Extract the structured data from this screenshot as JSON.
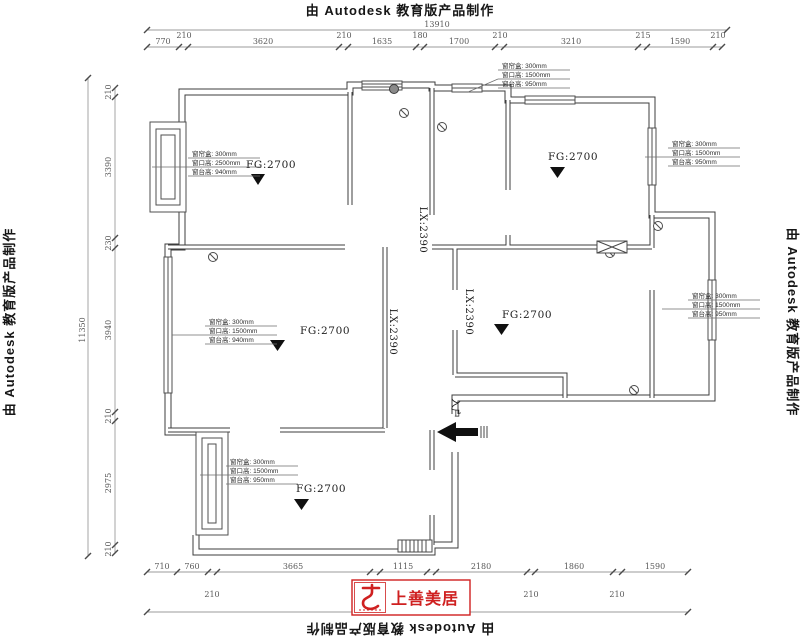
{
  "watermarks": {
    "top": "由 Autodesk 教育版产品制作",
    "bottom": "由 Autodesk 教育版产品制作",
    "left": "由 Autodesk 教育版产品制作",
    "right": "由 Autodesk 教育版产品制作"
  },
  "logo": {
    "text": "上善美居"
  },
  "rooms": {
    "fg_label": "FG:2700",
    "lx_label": "LX:2390",
    "entry_label": "入户"
  },
  "callout_rows": {
    "left_top": [
      "窗帘盒: 300mm",
      "窗口高: 2500mm",
      "窗台高: 940mm"
    ],
    "top_right": [
      "窗帘盒: 300mm",
      "窗口高: 1500mm",
      "窗台高: 950mm"
    ],
    "right_top": [
      "窗帘盒: 300mm",
      "窗口高: 1500mm",
      "窗台高: 950mm"
    ],
    "right_middle": [
      "窗帘盒: 300mm",
      "窗口高: 1500mm",
      "窗台高: 950mm"
    ],
    "left_middle": [
      "窗帘盒: 300mm",
      "窗口高: 1500mm",
      "窗台高: 940mm"
    ],
    "bottom": [
      "窗帘盒: 300mm",
      "窗口高: 1500mm",
      "窗台高: 950mm"
    ]
  },
  "dims": {
    "top": {
      "overall": "13910",
      "segments": [
        "770",
        "210",
        "3620",
        "210",
        "1635",
        "180",
        "1700",
        "210",
        "3210",
        "215",
        "1590",
        "210"
      ]
    },
    "left": {
      "overall": "11350",
      "segments": [
        "210",
        "3390",
        "230",
        "3940",
        "210",
        "2975",
        "210"
      ]
    },
    "bottom": {
      "overall": "13910",
      "row1": [
        "710",
        "760",
        "3665",
        "1115",
        "2180",
        "1860",
        "1590"
      ],
      "row2": [
        "210",
        "250",
        "210",
        "210",
        "210"
      ]
    }
  }
}
